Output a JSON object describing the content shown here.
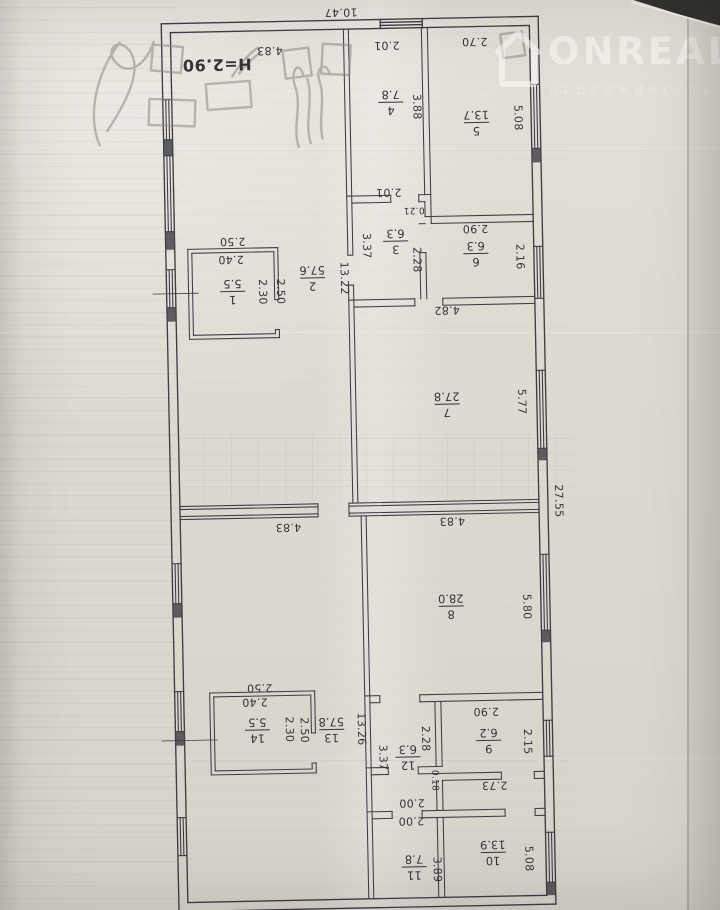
{
  "watermark": {
    "brand": "ONREALT",
    "subtitle": "НЕДВИЖИМОСТЬ",
    "logo": "house-icon"
  },
  "colors": {
    "paper": "#e0dcd4",
    "ink": "#3e3d44",
    "pencil": "#8d8983",
    "backdrop": "#2b2926",
    "watermark_text": "#ffffff"
  },
  "plan": {
    "orientation_note": "floor plan photographed upside down; all labels appear rotated",
    "overall_width": "10.47",
    "overall_length": "27.55",
    "ceiling_height": "H=2.90",
    "rooms": [
      {
        "n": "1",
        "a": "5.5",
        "x": 236,
        "y": 289
      },
      {
        "n": "2",
        "a": "57.6",
        "x": 316,
        "y": 277
      },
      {
        "n": "3",
        "a": "6.3",
        "x": 400,
        "y": 242
      },
      {
        "n": "4",
        "a": "7.8",
        "x": 398,
        "y": 103
      },
      {
        "n": "5",
        "a": "13.7",
        "x": 483,
        "y": 125
      },
      {
        "n": "6",
        "a": "6.3",
        "x": 480,
        "y": 256
      },
      {
        "n": "7",
        "a": "27.8",
        "x": 448,
        "y": 406
      },
      {
        "n": "8",
        "a": "28.0",
        "x": 448,
        "y": 608
      },
      {
        "n": "9",
        "a": "6.2",
        "x": 483,
        "y": 743
      },
      {
        "n": "10",
        "a": "13.9",
        "x": 485,
        "y": 855
      },
      {
        "n": "11",
        "a": "7.8",
        "x": 406,
        "y": 868
      },
      {
        "n": "12",
        "a": "6.3",
        "x": 402,
        "y": 758
      },
      {
        "n": "13",
        "a": "57.8",
        "x": 326,
        "y": 729
      },
      {
        "n": "14",
        "a": "5.5",
        "x": 252,
        "y": 728
      }
    ],
    "dims": [
      {
        "t": "10.47",
        "x": 350,
        "y": 12,
        "r": "u"
      },
      {
        "t": "4.83",
        "x": 278,
        "y": 49,
        "r": "u"
      },
      {
        "t": "H=2.90",
        "x": 225,
        "y": 62,
        "r": "u",
        "big": 1
      },
      {
        "t": "2.01",
        "x": 395,
        "y": 46,
        "r": "u"
      },
      {
        "t": "2.70",
        "x": 483,
        "y": 44,
        "r": "u"
      },
      {
        "t": "3.88",
        "x": 424,
        "y": 108,
        "r": "v"
      },
      {
        "t": "5.08",
        "x": 525,
        "y": 121,
        "r": "v"
      },
      {
        "t": "2.01",
        "x": 394,
        "y": 193,
        "r": "u"
      },
      {
        "t": "0.21",
        "x": 419,
        "y": 211,
        "r": "u",
        "s": 1
      },
      {
        "t": "2.90",
        "x": 480,
        "y": 231,
        "r": "u"
      },
      {
        "t": "3.37",
        "x": 371,
        "y": 246,
        "r": "v"
      },
      {
        "t": "2.28",
        "x": 421,
        "y": 261,
        "r": "v"
      },
      {
        "t": "2.16",
        "x": 524,
        "y": 260,
        "r": "v"
      },
      {
        "t": "13.22",
        "x": 348,
        "y": 278,
        "r": "v"
      },
      {
        "t": "2.50",
        "x": 237,
        "y": 239,
        "r": "u"
      },
      {
        "t": "2.40",
        "x": 235,
        "y": 257,
        "r": "u"
      },
      {
        "t": "2.30",
        "x": 266,
        "y": 290,
        "r": "v"
      },
      {
        "t": "2.50",
        "x": 284,
        "y": 290,
        "r": "v"
      },
      {
        "t": "4.82",
        "x": 450,
        "y": 312,
        "r": "u"
      },
      {
        "t": "5.77",
        "x": 523,
        "y": 405,
        "r": "v"
      },
      {
        "t": "27.55",
        "x": 558,
        "y": 505,
        "r": "v"
      },
      {
        "t": "4.83",
        "x": 287,
        "y": 526,
        "r": "u"
      },
      {
        "t": "4.83",
        "x": 451,
        "y": 523,
        "r": "u"
      },
      {
        "t": "5.80",
        "x": 524,
        "y": 610,
        "r": "v"
      },
      {
        "t": "2.50",
        "x": 255,
        "y": 686,
        "r": "u"
      },
      {
        "t": "2.40",
        "x": 250,
        "y": 700,
        "r": "u"
      },
      {
        "t": "2.30",
        "x": 284,
        "y": 728,
        "r": "v"
      },
      {
        "t": "2.50",
        "x": 299,
        "y": 729,
        "r": "v"
      },
      {
        "t": "13.26",
        "x": 356,
        "y": 729,
        "r": "v"
      },
      {
        "t": "3.37",
        "x": 377,
        "y": 758,
        "r": "v"
      },
      {
        "t": "2.28",
        "x": 420,
        "y": 740,
        "r": "v"
      },
      {
        "t": "2.90",
        "x": 481,
        "y": 714,
        "r": "u"
      },
      {
        "t": "2.15",
        "x": 522,
        "y": 745,
        "r": "v"
      },
      {
        "t": "0.18",
        "x": 428,
        "y": 782,
        "r": "v",
        "s": 1
      },
      {
        "t": "2.73",
        "x": 488,
        "y": 788,
        "r": "u"
      },
      {
        "t": "2.00",
        "x": 405,
        "y": 804,
        "r": "u"
      },
      {
        "t": "2.00",
        "x": 404,
        "y": 822,
        "r": "u"
      },
      {
        "t": "3.89",
        "x": 429,
        "y": 871,
        "r": "v"
      },
      {
        "t": "5.08",
        "x": 521,
        "y": 862,
        "r": "v"
      }
    ]
  }
}
